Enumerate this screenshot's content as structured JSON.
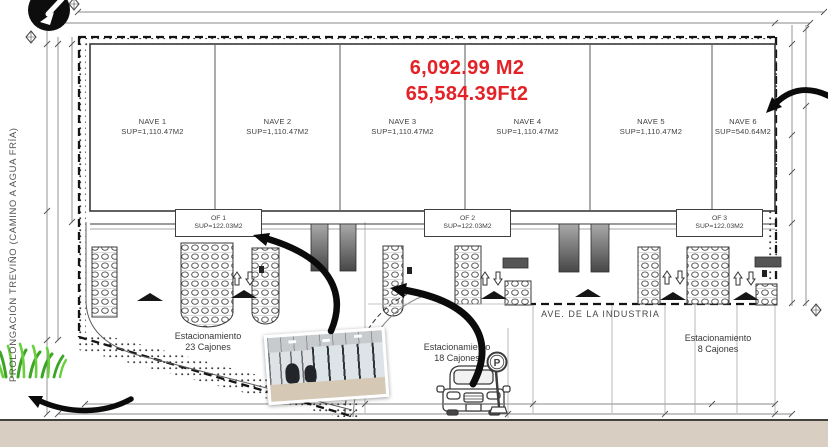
{
  "streets": {
    "left_vertical": "PROLONGACIÓN TREVIÑO (CAMINO A AGUA FRÍA)",
    "bottom": "AVE. DE LA INDUSTRIA"
  },
  "total_area": {
    "m2": "6,092.99 M2",
    "ft2": "65,584.39Ft2"
  },
  "naves": [
    {
      "name": "NAVE 1",
      "sup": "SUP=1,110.47M2"
    },
    {
      "name": "NAVE 2",
      "sup": "SUP=1,110.47M2"
    },
    {
      "name": "NAVE 3",
      "sup": "SUP=1,110.47M2"
    },
    {
      "name": "NAVE 4",
      "sup": "SUP=1,110.47M2"
    },
    {
      "name": "NAVE 5",
      "sup": "SUP=1,110.47M2"
    },
    {
      "name": "NAVE 6",
      "sup": "SUP=540.64M2"
    }
  ],
  "offices": [
    {
      "name": "OF 1",
      "sup": "SUP=122.03M2"
    },
    {
      "name": "OF 2",
      "sup": "SUP=122.03M2"
    },
    {
      "name": "OF 3",
      "sup": "SUP=122.03M2"
    }
  ],
  "parking_lots": [
    {
      "line1": "Estacionamiento",
      "line2": "23 Cajones"
    },
    {
      "line1": "Estacionamiento",
      "line2": "18 Cajones"
    },
    {
      "line1": "Estacionamiento",
      "line2": "8 Cajones"
    }
  ],
  "icons": {
    "parking_sign_letter": "P"
  },
  "colors": {
    "accent_red": "#e32227",
    "line_dark": "#2f2f2f",
    "tan_strip": "#d8cfc2",
    "grass_green": "#46b42a",
    "stair_gray": "#6e6e6e"
  }
}
